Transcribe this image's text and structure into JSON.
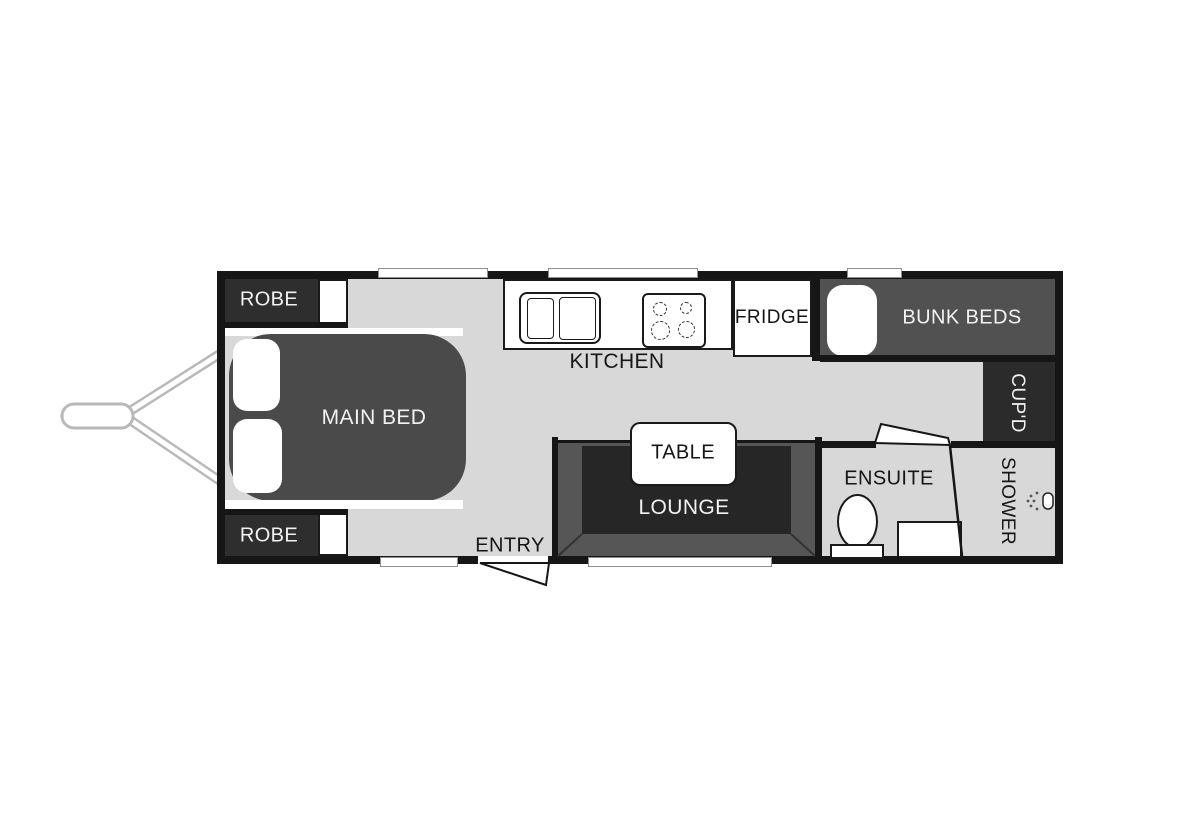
{
  "plan_title": "caravan-floorplan",
  "rooms": {
    "robe_top": {
      "label": "ROBE"
    },
    "robe_bottom": {
      "label": "ROBE"
    },
    "main_bed": {
      "label": "MAIN BED"
    },
    "kitchen": {
      "label": "KITCHEN"
    },
    "fridge": {
      "label": "FRIDGE"
    },
    "bunk_beds": {
      "label": "BUNK BEDS"
    },
    "cupboard": {
      "label": "CUP'D"
    },
    "dinette": {
      "table_label": "TABLE",
      "lounge_label": "LOUNGE"
    },
    "entry": {
      "label": "ENTRY"
    },
    "ensuite": {
      "label": "ENSUITE"
    },
    "shower": {
      "label": "SHOWER"
    }
  },
  "colors": {
    "floor": "#d8d8d8",
    "wall": "#161616",
    "furniture_dark": "#4a4a4a",
    "cabinet_dark": "#2e2e2e",
    "bunk": "#515151",
    "lounge_bench": "#565656",
    "lounge_inner": "#262626",
    "hitch": "#b9b9b9",
    "fixture_white": "#ffffff",
    "label_light": "#f2f2f2",
    "label_dark": "#161616"
  }
}
